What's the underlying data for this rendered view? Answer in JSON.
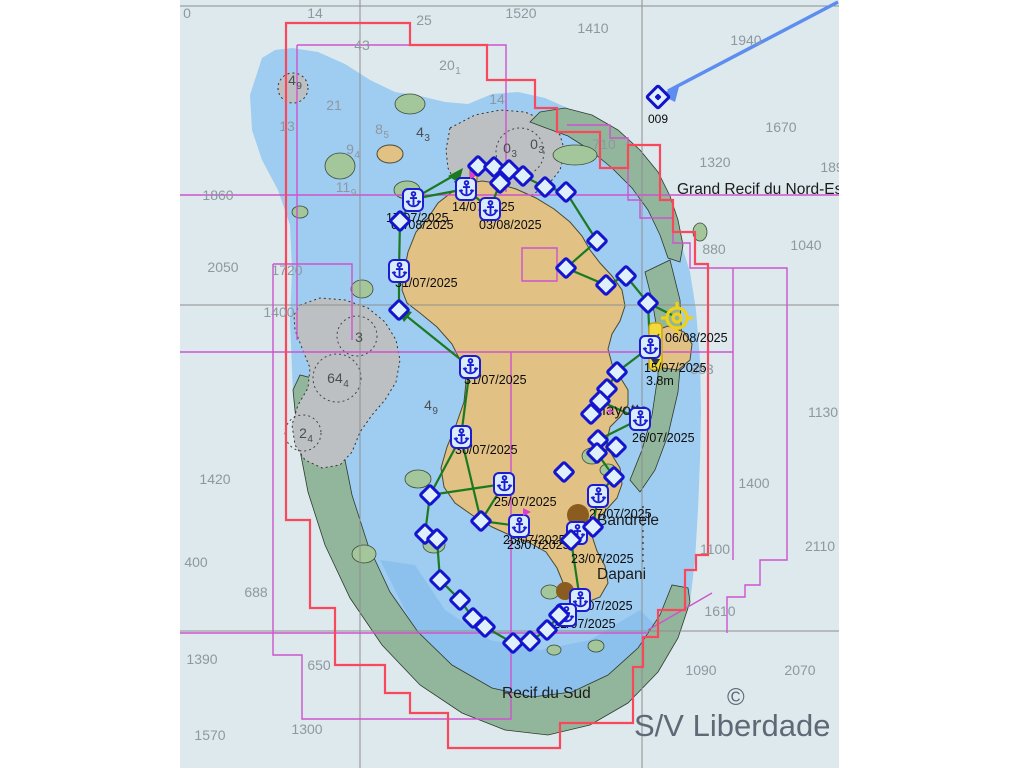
{
  "watermark": {
    "text": "S/V Liberdade",
    "copyright": "©"
  },
  "named_waypoint": {
    "label": "009",
    "x": 658,
    "y": 97
  },
  "colors": {
    "deep_sea": "#dde9ed",
    "lagoon": "#9fccf1",
    "lagoon_inner": "#86bdec",
    "land": "#e2c185",
    "reef_green": "#92b69b",
    "drying_bank": "#bcc0c2",
    "track_green": "#1b7a1f",
    "waypoint_blue": "#1414cf",
    "anchor_blue": "#1c1cd2",
    "boundary_red": "#f9485c",
    "boundary_magenta": "#cd54cd",
    "gridline_gray": "#8f8f8f",
    "sounding_gray": "#8d98a0",
    "position_yellow": "#f0d018",
    "arrow_blue": "#5c8def",
    "watermark_gray": "#5d6a75",
    "town_brown": "#8a5c1f"
  },
  "map": {
    "texts": [
      {
        "t": "0",
        "x": 187,
        "y": 6,
        "c": "snd"
      },
      {
        "t": "14",
        "x": 315,
        "y": 6,
        "c": "snd"
      },
      {
        "t": "25",
        "x": 424,
        "y": 13,
        "c": "snd"
      },
      {
        "t": "1520",
        "x": 521,
        "y": 6,
        "c": "snd"
      },
      {
        "t": "1410",
        "x": 593,
        "y": 21,
        "c": "snd"
      },
      {
        "t": "1940",
        "x": 746,
        "y": 33,
        "c": "snd"
      },
      {
        "t": "43",
        "x": 362,
        "y": 38,
        "c": "snd"
      },
      {
        "t": "20",
        "sub": "1",
        "x": 450,
        "y": 58,
        "c": "snd"
      },
      {
        "t": "4",
        "sub": "9",
        "x": 295,
        "y": 73,
        "c": "sndd"
      },
      {
        "t": "21",
        "x": 334,
        "y": 98,
        "c": "snd"
      },
      {
        "t": "14",
        "x": 497,
        "y": 92,
        "c": "snd"
      },
      {
        "t": "13",
        "x": 287,
        "y": 119,
        "c": "snd"
      },
      {
        "t": "8",
        "sub": "5",
        "x": 382,
        "y": 122,
        "c": "snd"
      },
      {
        "t": "4",
        "sub": "3",
        "x": 423,
        "y": 125,
        "c": "sndd"
      },
      {
        "t": "9",
        "sub": "4",
        "x": 353,
        "y": 142,
        "c": "snd"
      },
      {
        "t": "0",
        "sub": "3",
        "x": 510,
        "y": 141,
        "c": "sndd"
      },
      {
        "t": "0",
        "sub": "3",
        "x": 537,
        "y": 137,
        "c": "sndd"
      },
      {
        "t": "710",
        "x": 604,
        "y": 137,
        "c": "snd"
      },
      {
        "t": "1670",
        "x": 781,
        "y": 120,
        "c": "snd"
      },
      {
        "t": "1320",
        "x": 715,
        "y": 155,
        "c": "snd"
      },
      {
        "t": "189",
        "x": 832,
        "y": 160,
        "c": "snd"
      },
      {
        "t": "11",
        "sub": "9",
        "x": 346,
        "y": 180,
        "c": "snd"
      },
      {
        "t": "1860",
        "x": 218,
        "y": 188,
        "c": "snd"
      },
      {
        "t": "880",
        "x": 714,
        "y": 242,
        "c": "snd"
      },
      {
        "t": "1040",
        "x": 806,
        "y": 238,
        "c": "snd"
      },
      {
        "t": "2050",
        "x": 223,
        "y": 260,
        "c": "snd"
      },
      {
        "t": "1720",
        "x": 287,
        "y": 263,
        "c": "snd"
      },
      {
        "t": "1400",
        "x": 279,
        "y": 305,
        "c": "snd"
      },
      {
        "t": "3",
        "x": 359,
        "y": 330,
        "c": "sndd"
      },
      {
        "t": "64",
        "sub": "4",
        "x": 338,
        "y": 371,
        "c": "sndd"
      },
      {
        "t": "883",
        "x": 702,
        "y": 362,
        "c": "snd"
      },
      {
        "t": "4",
        "sub": "9",
        "x": 431,
        "y": 398,
        "c": "sndd"
      },
      {
        "t": "1130",
        "x": 823,
        "y": 405,
        "c": "snd"
      },
      {
        "t": "2",
        "sub": "4",
        "x": 306,
        "y": 426,
        "c": "sndd"
      },
      {
        "t": "1420",
        "x": 215,
        "y": 472,
        "c": "snd"
      },
      {
        "t": "1400",
        "x": 754,
        "y": 476,
        "c": "snd"
      },
      {
        "t": "2110",
        "x": 820,
        "y": 539,
        "c": "snd"
      },
      {
        "t": "1100",
        "x": 715,
        "y": 542,
        "c": "snd"
      },
      {
        "t": "400",
        "x": 196,
        "y": 555,
        "c": "snd"
      },
      {
        "t": "688",
        "x": 256,
        "y": 585,
        "c": "snd"
      },
      {
        "t": "1610",
        "x": 720,
        "y": 604,
        "c": "snd"
      },
      {
        "t": "1390",
        "x": 202,
        "y": 652,
        "c": "snd"
      },
      {
        "t": "650",
        "x": 319,
        "y": 658,
        "c": "snd"
      },
      {
        "t": "1090",
        "x": 701,
        "y": 663,
        "c": "snd"
      },
      {
        "t": "2070",
        "x": 800,
        "y": 663,
        "c": "snd"
      },
      {
        "t": "1300",
        "x": 307,
        "y": 722,
        "c": "snd"
      },
      {
        "t": "1570",
        "x": 210,
        "y": 728,
        "c": "snd"
      },
      {
        "t": "Grand Recif du Nord-Est",
        "x": 677,
        "y": 182,
        "c": "place"
      },
      {
        "t": "Mayotte",
        "x": 593,
        "y": 403,
        "c": "place"
      },
      {
        "t": "Bandrele",
        "x": 597,
        "y": 513,
        "c": "place"
      },
      {
        "t": "Dapani",
        "x": 597,
        "y": 567,
        "c": "place"
      },
      {
        "t": "Recif du Sud",
        "x": 502,
        "y": 686,
        "c": "place"
      },
      {
        "t": "+",
        "x": 606,
        "y": 404,
        "c": "pink"
      },
      {
        "t": "14/07/2025",
        "x": 452,
        "y": 201,
        "c": "date"
      },
      {
        "t": "17/07/2025",
        "x": 386,
        "y": 212,
        "c": "date"
      },
      {
        "t": "07/08/2025",
        "x": 391,
        "y": 219,
        "c": "date"
      },
      {
        "t": "03/08/2025",
        "x": 479,
        "y": 219,
        "c": "date"
      },
      {
        "t": "31/07/2025",
        "x": 395,
        "y": 277,
        "c": "date"
      },
      {
        "t": "31/07/2025",
        "x": 464,
        "y": 374,
        "c": "date"
      },
      {
        "t": "30/07/2025",
        "x": 455,
        "y": 444,
        "c": "date"
      },
      {
        "t": "25/07/2025",
        "x": 494,
        "y": 496,
        "c": "date"
      },
      {
        "t": "25/07/2025",
        "x": 503,
        "y": 534,
        "c": "date"
      },
      {
        "t": "23/07/2025",
        "x": 507,
        "y": 539,
        "c": "date"
      },
      {
        "t": "27/07/2025",
        "x": 589,
        "y": 508,
        "c": "date"
      },
      {
        "t": "23/07/2025",
        "x": 571,
        "y": 553,
        "c": "date"
      },
      {
        "t": "26/07/2025",
        "x": 632,
        "y": 432,
        "c": "date"
      },
      {
        "t": "15/07/2025",
        "x": 644,
        "y": 362,
        "c": "date"
      },
      {
        "t": "3.8m",
        "x": 646,
        "y": 375,
        "c": "date"
      },
      {
        "t": "06/08/2025",
        "x": 665,
        "y": 332,
        "c": "date"
      },
      {
        "t": "24/07/2025",
        "x": 570,
        "y": 600,
        "c": "date"
      },
      {
        "t": "21/07/2025",
        "x": 553,
        "y": 618,
        "c": "date"
      }
    ],
    "anchorages": [
      {
        "x": 413,
        "y": 200
      },
      {
        "x": 466,
        "y": 189,
        "flag": 1
      },
      {
        "x": 490,
        "y": 209
      },
      {
        "x": 399,
        "y": 271
      },
      {
        "x": 470,
        "y": 367
      },
      {
        "x": 461,
        "y": 437
      },
      {
        "x": 504,
        "y": 484
      },
      {
        "x": 519,
        "y": 526,
        "flag": 1
      },
      {
        "x": 598,
        "y": 496
      },
      {
        "x": 577,
        "y": 533
      },
      {
        "x": 640,
        "y": 419
      },
      {
        "x": 650,
        "y": 347
      },
      {
        "x": 580,
        "y": 600
      },
      {
        "x": 566,
        "y": 615
      }
    ],
    "waypoints": [
      {
        "x": 478,
        "y": 166
      },
      {
        "x": 494,
        "y": 167
      },
      {
        "x": 509,
        "y": 170
      },
      {
        "x": 500,
        "y": 183
      },
      {
        "x": 523,
        "y": 176
      },
      {
        "x": 545,
        "y": 187
      },
      {
        "x": 566,
        "y": 192
      },
      {
        "x": 597,
        "y": 241
      },
      {
        "x": 566,
        "y": 268
      },
      {
        "x": 606,
        "y": 285
      },
      {
        "x": 626,
        "y": 276
      },
      {
        "x": 648,
        "y": 303
      },
      {
        "x": 400,
        "y": 221
      },
      {
        "x": 399,
        "y": 310
      },
      {
        "x": 617,
        "y": 372
      },
      {
        "x": 607,
        "y": 389
      },
      {
        "x": 600,
        "y": 401
      },
      {
        "x": 591,
        "y": 414
      },
      {
        "x": 598,
        "y": 440
      },
      {
        "x": 616,
        "y": 447
      },
      {
        "x": 597,
        "y": 453
      },
      {
        "x": 564,
        "y": 472
      },
      {
        "x": 614,
        "y": 477
      },
      {
        "x": 593,
        "y": 527
      },
      {
        "x": 571,
        "y": 540
      },
      {
        "x": 430,
        "y": 495
      },
      {
        "x": 481,
        "y": 521
      },
      {
        "x": 425,
        "y": 534
      },
      {
        "x": 437,
        "y": 539
      },
      {
        "x": 440,
        "y": 580
      },
      {
        "x": 460,
        "y": 600
      },
      {
        "x": 473,
        "y": 618
      },
      {
        "x": 485,
        "y": 627
      },
      {
        "x": 513,
        "y": 643
      },
      {
        "x": 530,
        "y": 641
      },
      {
        "x": 547,
        "y": 630
      },
      {
        "x": 559,
        "y": 615
      }
    ]
  }
}
